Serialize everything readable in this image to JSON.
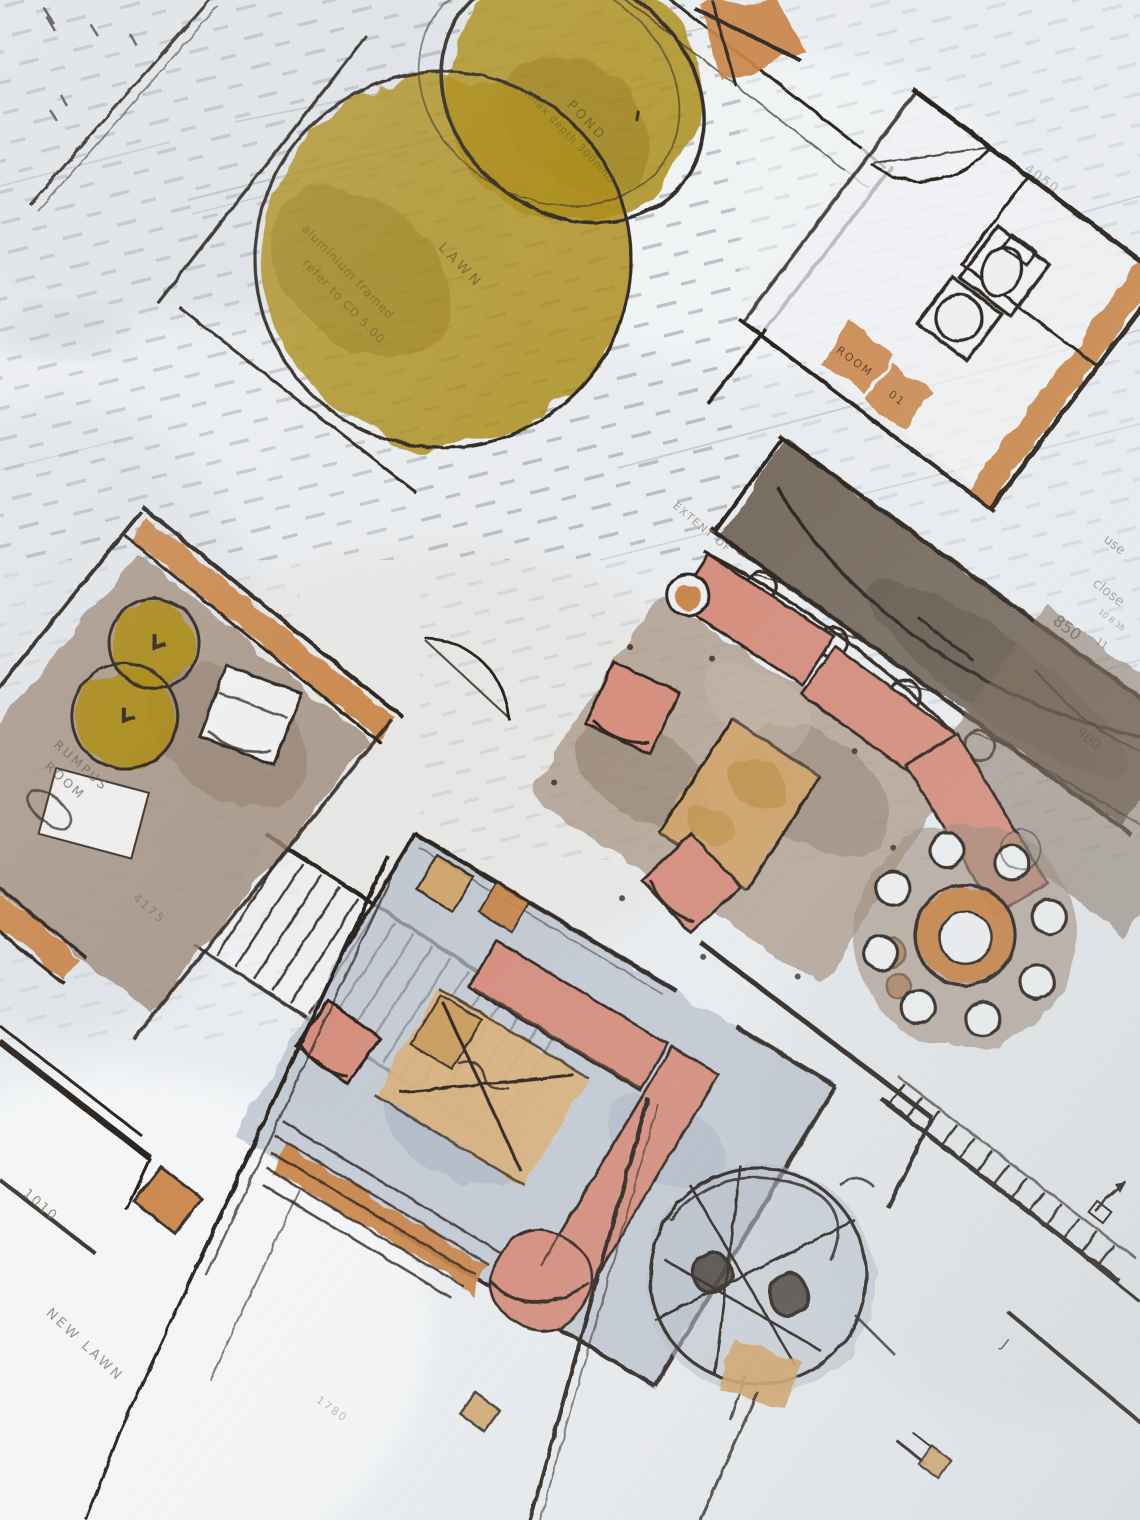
{
  "scene": {
    "title": "Hand-drawn architectural floor plan",
    "medium": "ink and watercolour sketch on tracing paper over a printed plan",
    "rooms": [
      "garden with pond and lawn",
      "bathroom",
      "kitchen bench",
      "living room",
      "dining table",
      "media room",
      "rumpus room",
      "deck walkway",
      "new lawn"
    ]
  },
  "palette": {
    "paper": "#eaedf0",
    "ink": "#2b231c",
    "wash_olive": "#a8870f",
    "wash_orange": "#c8803f",
    "wash_pink": "#d58d7c",
    "wash_tan": "#d2a365",
    "wash_taupe": "#9c8877",
    "wash_umber": "#6e6052",
    "wash_slate": "#b4bdc9",
    "ghost_print": "#8d96a0",
    "pencil": "#847767"
  },
  "labels": {
    "pond": "POND",
    "pond_note": "(max depth 300mm)",
    "lawn": "LAWN",
    "glazing_note_line1": "aluminium framed",
    "glazing_note_line2": "refer to CD 5.00",
    "room_tag_line1": "ROOM",
    "room_tag_line2": "01",
    "dim_4050": "4050",
    "note_use": "use",
    "note_close": "close",
    "extent_note": "EXTENT OF",
    "dim_850": "850",
    "dim_850_sub": "11",
    "dim_850_small": "10 8 38",
    "dim_900": "900",
    "rumpus_line1": "RUMPUS",
    "rumpus_line2": "ROOM",
    "dim_4175": "4175",
    "dim_1010": "1010",
    "new_lawn": "NEW LAWN",
    "dim_1780": "1780",
    "mark_j": "J"
  }
}
